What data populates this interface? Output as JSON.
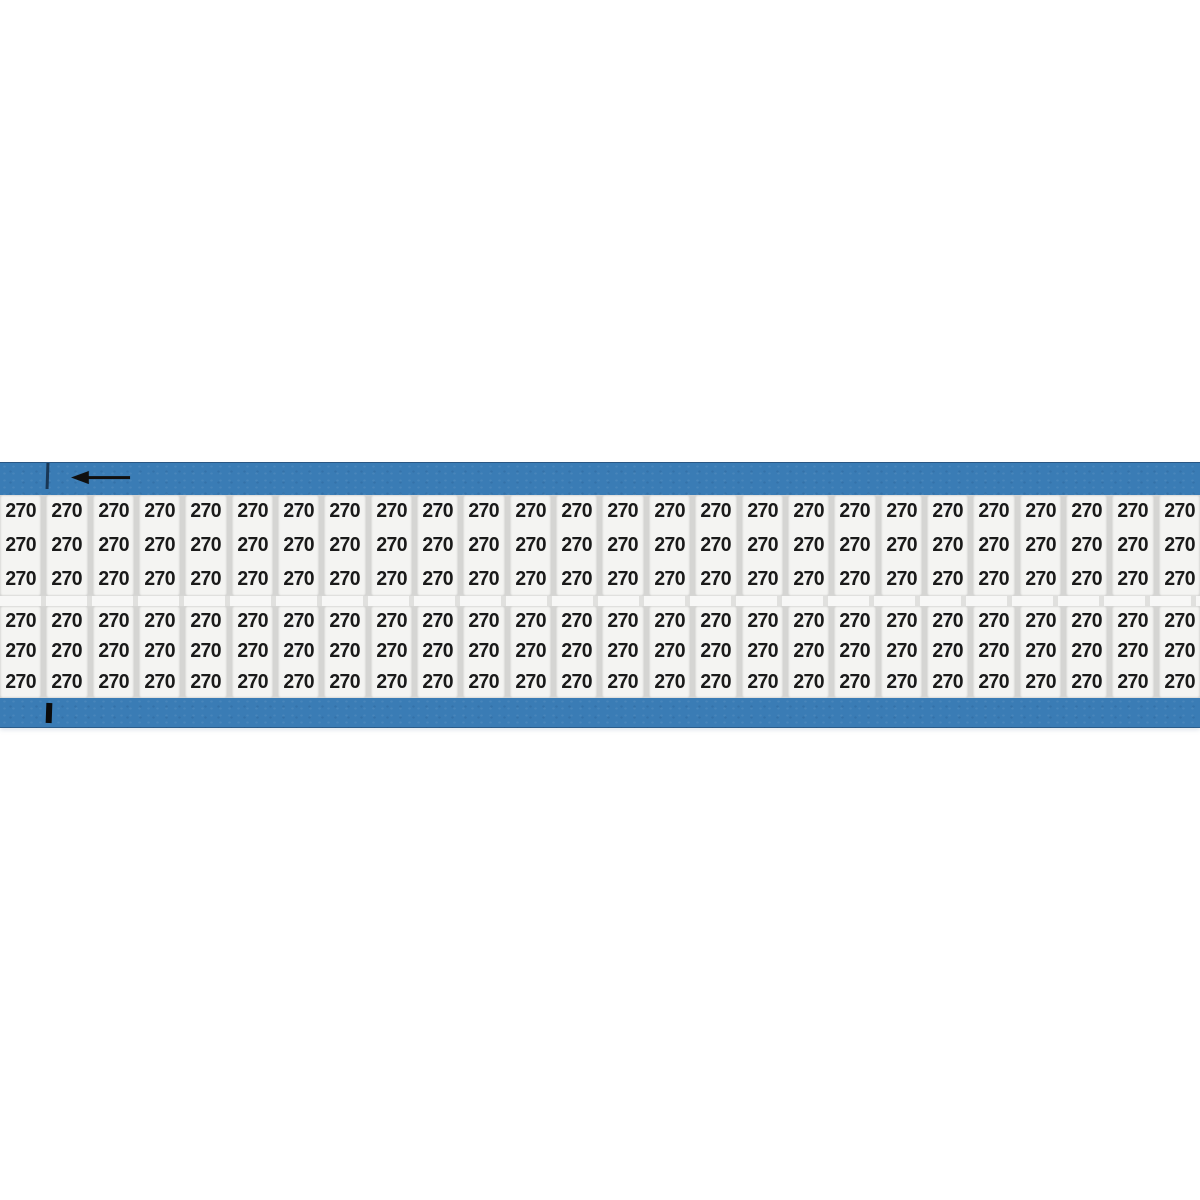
{
  "page": {
    "background_color": "#ffffff",
    "description": "Wire marker card product image"
  },
  "card": {
    "label_text": "270",
    "columns": 26,
    "sections": 2,
    "rows_per_section": 3,
    "total_labels": 156,
    "colors": {
      "band_blue": "#3a7cb5",
      "band_edge": "#19375a",
      "label_background": "#f4f4f2",
      "column_gap_gray": "#d5d5d3",
      "section_gap": "#eeeeec",
      "label_text": "#1a1a1a",
      "mark_black": "#0b0b0b"
    },
    "icons": {
      "direction_arrow": "left-arrow-icon",
      "registration_marks": [
        "top-tick",
        "bottom-tick"
      ]
    }
  }
}
